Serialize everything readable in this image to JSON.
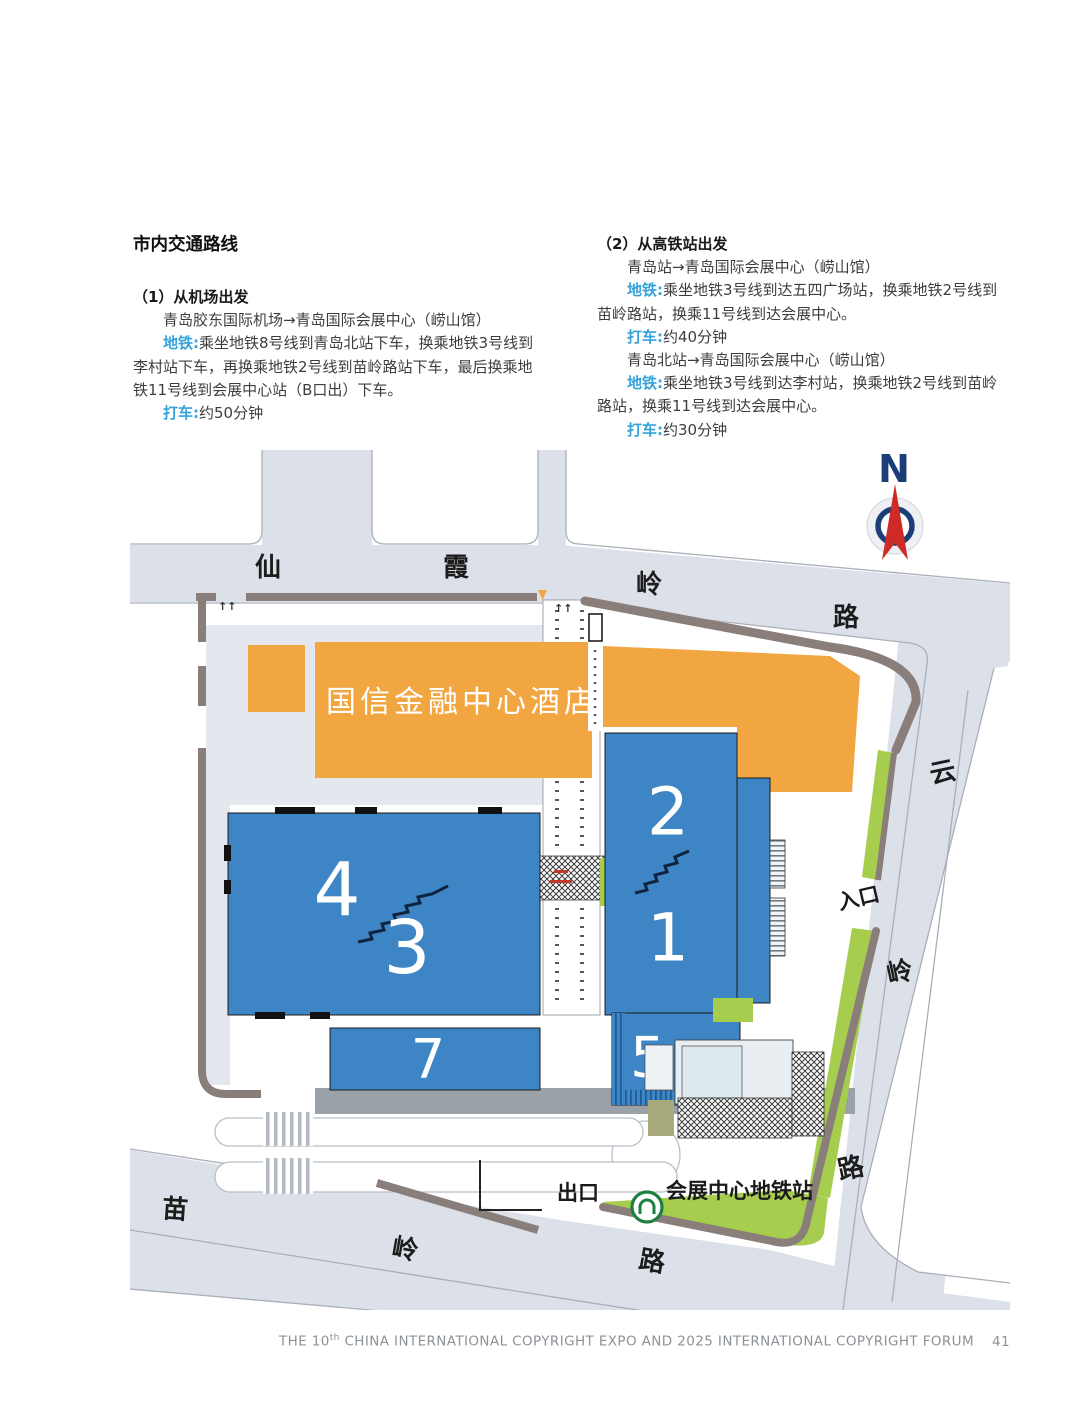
{
  "colors": {
    "accent": "#35a3da",
    "building_blue": "#3e85c5",
    "hotel_orange": "#f1a642",
    "green": "#a6cd4e",
    "road": "#dce1e9",
    "road_line": "#a9aeb8",
    "wall": "#8a7e7a",
    "metro_green": "#1d8040",
    "compass_navy": "#1b3e78",
    "compass_red": "#cf2b26"
  },
  "intro": {
    "title": "市内交通路线"
  },
  "routes": {
    "airport": {
      "heading": "（1）从机场出发",
      "route_line": "青岛胶东国际机场→青岛国际会展中心（崂山馆）",
      "metro_label": "地铁:",
      "metro_text": "乘坐地铁8号线到青岛北站下车，换乘地铁3号线到李村站下车，再换乘地铁2号线到苗岭路站下车，最后换乘地铁11号线到会展中心站（B口出）下车。",
      "taxi_label": "打车:",
      "taxi_text": "约50分钟"
    },
    "rail": {
      "heading": "（2）从高铁站出发",
      "route_line_1": "青岛站→青岛国际会展中心（崂山馆）",
      "metro_label_1": "地铁:",
      "metro_text_1": "乘坐地铁3号线到达五四广场站，换乘地铁2号线到苗岭路站，换乘11号线到达会展中心。",
      "taxi_label_1": "打车:",
      "taxi_text_1": "约40分钟",
      "route_line_2": "青岛北站→青岛国际会展中心（崂山馆）",
      "metro_label_2": "地铁:",
      "metro_text_2": "乘坐地铁3号线到达李村站，换乘地铁2号线到苗岭路站，换乘11号线到达会展中心。",
      "taxi_label_2": "打车:",
      "taxi_text_2": "约30分钟"
    }
  },
  "map": {
    "compass": "N",
    "hotel": "国信金融中心酒店",
    "road_top": [
      "仙",
      "霞",
      "岭",
      "路"
    ],
    "road_right": [
      "云",
      "岭",
      "路"
    ],
    "road_bottom": [
      "苗",
      "岭",
      "路"
    ],
    "entrance": "入口",
    "exit": "出口",
    "station": "会展中心地铁站",
    "halls": {
      "h4": "4",
      "h3": "3",
      "h2": "2",
      "h1": "1",
      "h7": "7",
      "h5": "5"
    }
  },
  "footer": {
    "prefix": "THE 10",
    "sup": "th",
    "suffix": " CHINA INTERNATIONAL COPYRIGHT EXPO AND 2025 INTERNATIONAL COPYRIGHT FORUM",
    "page": "41"
  }
}
